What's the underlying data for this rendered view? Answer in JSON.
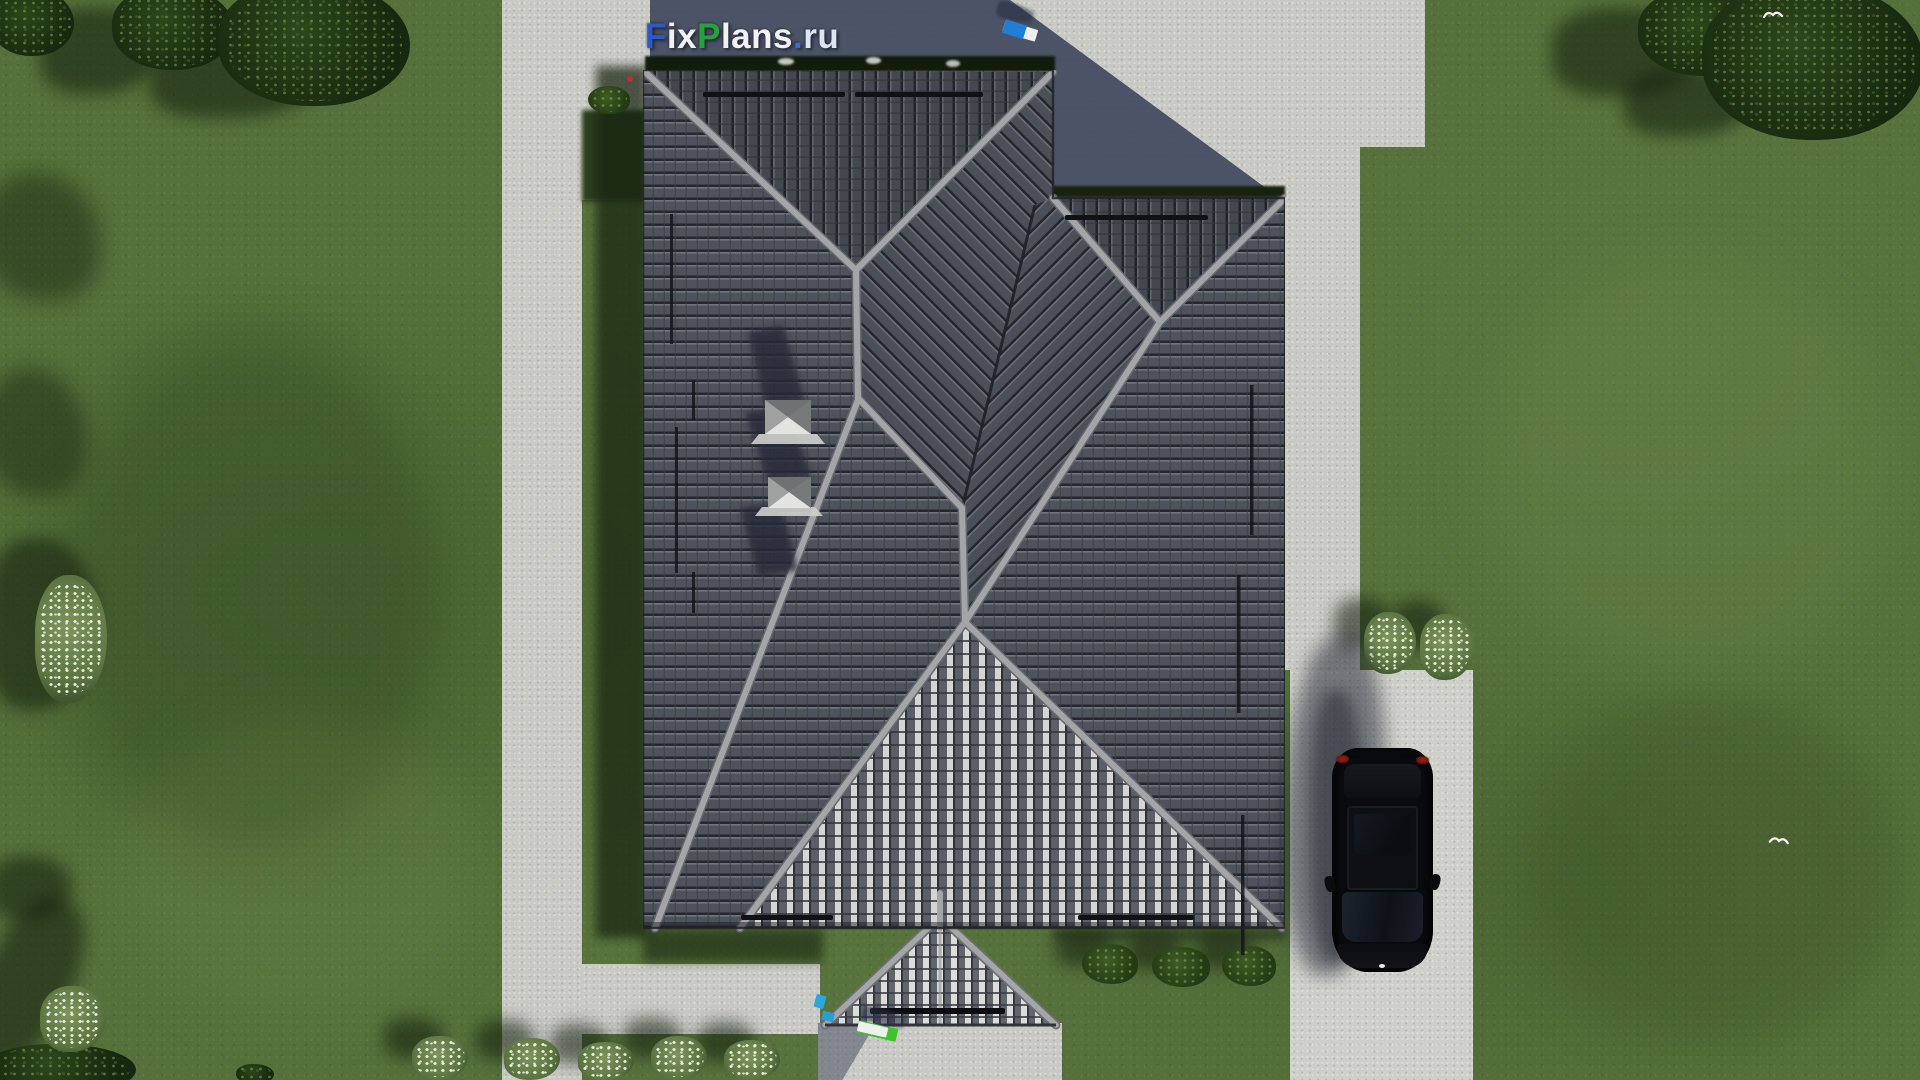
{
  "brand": {
    "site": "FixPlans.ru",
    "parts": [
      {
        "t": "F",
        "c": "#2e5ac6"
      },
      {
        "t": "ix",
        "c": "#f1f2f4"
      },
      {
        "t": "P",
        "c": "#27a23b"
      },
      {
        "t": "lans",
        "c": "#f1f2f4"
      },
      {
        "t": ".",
        "c": "#3a6ad4"
      },
      {
        "t": "ru",
        "c": "#dde4f2"
      }
    ]
  },
  "watermark3d": {
    "colors": {
      "white": "#eef0ee",
      "blue": "#1f7fd4",
      "green": "#3ec32b",
      "shadow": "#262e41"
    },
    "top": {
      "x": 1004,
      "y": 26,
      "angle": 17,
      "shadow_dx": -9,
      "shadow_dy": -16,
      "blocks": [
        [
          "white",
          30,
          11
        ],
        [
          "blue",
          12,
          12
        ],
        [
          "white",
          34,
          12
        ],
        [
          "white",
          24,
          11
        ],
        [
          "white",
          10,
          10
        ],
        [
          "green",
          20,
          9
        ],
        [
          "white",
          24,
          9
        ],
        [
          "green",
          8,
          8
        ],
        [
          "blue",
          22,
          14
        ]
      ]
    },
    "bottom": {
      "x": 858,
      "y": 1026,
      "angle": 13,
      "shadow_dx": 4,
      "shadow_dy": -15,
      "blocks": [
        [
          "green",
          40,
          13
        ],
        [
          "white",
          20,
          9
        ],
        [
          "white",
          28,
          9
        ],
        [
          "white",
          24,
          9
        ],
        [
          "blue",
          14,
          10
        ],
        [
          "white",
          30,
          10
        ]
      ]
    }
  },
  "palette": {
    "grass": "#55703a",
    "grass_shadow": "#27391c",
    "pavement": "#c9c9c4",
    "pavement_shadow": "#474e63",
    "roof_tile_dark": "#4e525a",
    "roof_tile_bright": "#d5d6d3",
    "roof_ridge": "#a3a5a7",
    "car": "#0a0b0e",
    "taillight": "#8c1a12"
  }
}
